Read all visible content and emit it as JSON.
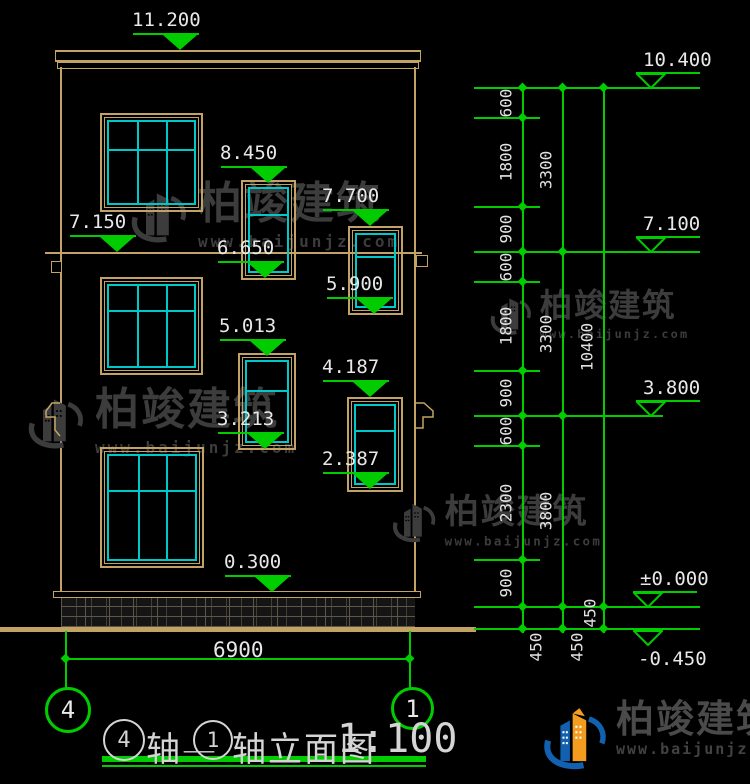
{
  "colors": {
    "outline_tan": "#c3a365",
    "window_teal": "#00c8c8",
    "dimension_green": "#00cc00",
    "text_white": "#e8e8e8",
    "watermark_gray": "#3c3c3c",
    "brand_blue": "#1261b0",
    "brand_orange": "#f49c1f"
  },
  "watermark": {
    "brand": "柏竣建筑",
    "url": "www.baijunjz.com"
  },
  "watermark_positions": [
    {
      "x": 128,
      "y": 182,
      "s": 1.0
    },
    {
      "x": 25,
      "y": 388,
      "s": 1.0
    },
    {
      "x": 488,
      "y": 290,
      "s": 0.74
    },
    {
      "x": 390,
      "y": 495,
      "s": 0.78
    }
  ],
  "title": {
    "axis_start": "4",
    "joiner": "轴—",
    "axis_end": "1",
    "name": "轴立面图",
    "scale": "1:100"
  },
  "axis_bubbles": {
    "left": "4",
    "right": "1"
  },
  "footer_dim": {
    "overall_width": "6900"
  },
  "levels_left": [
    {
      "label": "11.200",
      "ax": 180,
      "ay": 50
    },
    {
      "label": "7.150",
      "ax": 117,
      "ay": 252
    },
    {
      "label": "8.450",
      "ax": 268,
      "ay": 183
    },
    {
      "label": "7.700",
      "ax": 370,
      "ay": 226
    },
    {
      "label": "6.650",
      "ax": 265,
      "ay": 278
    },
    {
      "label": "5.900",
      "ax": 374,
      "ay": 314
    },
    {
      "label": "5.013",
      "ax": 267,
      "ay": 356
    },
    {
      "label": "4.187",
      "ax": 370,
      "ay": 397
    },
    {
      "label": "3.213",
      "ax": 265,
      "ay": 449
    },
    {
      "label": "2.387",
      "ax": 370,
      "ay": 489
    },
    {
      "label": "0.300",
      "ax": 272,
      "ay": 592
    }
  ],
  "levels_right": [
    {
      "label": "10.400",
      "ax": 651,
      "ay": 88,
      "inverted": false
    },
    {
      "label": "7.100",
      "ax": 651,
      "ay": 252,
      "inverted": false
    },
    {
      "label": "3.800",
      "ax": 651,
      "ay": 416,
      "inverted": false
    },
    {
      "label": "±0.000",
      "ax": 648,
      "ay": 607,
      "inverted": false
    },
    {
      "label": "-0.450",
      "ax": 648,
      "ay": 629,
      "inverted": true
    }
  ],
  "dim_chain": {
    "chain_lines": [
      {
        "x": 523,
        "y1": 88,
        "y2": 633
      },
      {
        "x": 563,
        "y1": 88,
        "y2": 633
      },
      {
        "x": 604,
        "y1": 88,
        "y2": 633
      }
    ],
    "ext_lines": [
      {
        "y": 88,
        "x1": 474,
        "x2": 700
      },
      {
        "y": 118,
        "x1": 474,
        "x2": 540
      },
      {
        "y": 207,
        "x1": 474,
        "x2": 540
      },
      {
        "y": 252,
        "x1": 474,
        "x2": 700
      },
      {
        "y": 282,
        "x1": 474,
        "x2": 540
      },
      {
        "y": 371,
        "x1": 474,
        "x2": 540
      },
      {
        "y": 416,
        "x1": 474,
        "x2": 663
      },
      {
        "y": 446,
        "x1": 474,
        "x2": 540
      },
      {
        "y": 560,
        "x1": 474,
        "x2": 540
      },
      {
        "y": 607,
        "x1": 474,
        "x2": 700
      },
      {
        "y": 629,
        "x1": 474,
        "x2": 700
      }
    ],
    "ticks": [
      {
        "x": 523,
        "ys": [
          88,
          118,
          207,
          252,
          282,
          371,
          416,
          446,
          560,
          607,
          629
        ]
      },
      {
        "x": 563,
        "ys": [
          88,
          252,
          416,
          607,
          629
        ]
      },
      {
        "x": 604,
        "ys": [
          88,
          607,
          629
        ]
      }
    ],
    "labels": [
      {
        "text": "600",
        "x": 506,
        "y": 103
      },
      {
        "text": "1800",
        "x": 506,
        "y": 162
      },
      {
        "text": "900",
        "x": 506,
        "y": 229
      },
      {
        "text": "600",
        "x": 506,
        "y": 267
      },
      {
        "text": "1800",
        "x": 506,
        "y": 326
      },
      {
        "text": "900",
        "x": 506,
        "y": 393
      },
      {
        "text": "600",
        "x": 506,
        "y": 431
      },
      {
        "text": "2300",
        "x": 506,
        "y": 503
      },
      {
        "text": "900",
        "x": 506,
        "y": 583
      },
      {
        "text": "450",
        "x": 536,
        "y": 647
      },
      {
        "text": "3300",
        "x": 546,
        "y": 170
      },
      {
        "text": "3300",
        "x": 546,
        "y": 334
      },
      {
        "text": "3800",
        "x": 546,
        "y": 511
      },
      {
        "text": "450",
        "x": 577,
        "y": 647
      },
      {
        "text": "10400",
        "x": 587,
        "y": 347
      },
      {
        "text": "450",
        "x": 590,
        "y": 613
      }
    ]
  },
  "windows": [
    {
      "x": 100,
      "y": 113,
      "w": 103,
      "h": 99,
      "vmull": 2,
      "hsplit": 0.33
    },
    {
      "x": 100,
      "y": 277,
      "w": 103,
      "h": 98,
      "vmull": 2,
      "hsplit": 0.3
    },
    {
      "x": 100,
      "y": 447,
      "w": 104,
      "h": 121,
      "vmull": 2,
      "hsplit": 0.33
    },
    {
      "x": 241,
      "y": 180,
      "w": 55,
      "h": 100,
      "vmull": 0,
      "hsplit": 0.3
    },
    {
      "x": 348,
      "y": 226,
      "w": 55,
      "h": 89,
      "vmull": 0,
      "hsplit": 0.3
    },
    {
      "x": 238,
      "y": 353,
      "w": 58,
      "h": 97,
      "vmull": 0,
      "hsplit": 0.36
    },
    {
      "x": 347,
      "y": 397,
      "w": 56,
      "h": 95,
      "vmull": 0,
      "hsplit": 0.31
    }
  ],
  "footer_dim_geometry": {
    "x1": 66,
    "x2": 410,
    "y": 659
  }
}
